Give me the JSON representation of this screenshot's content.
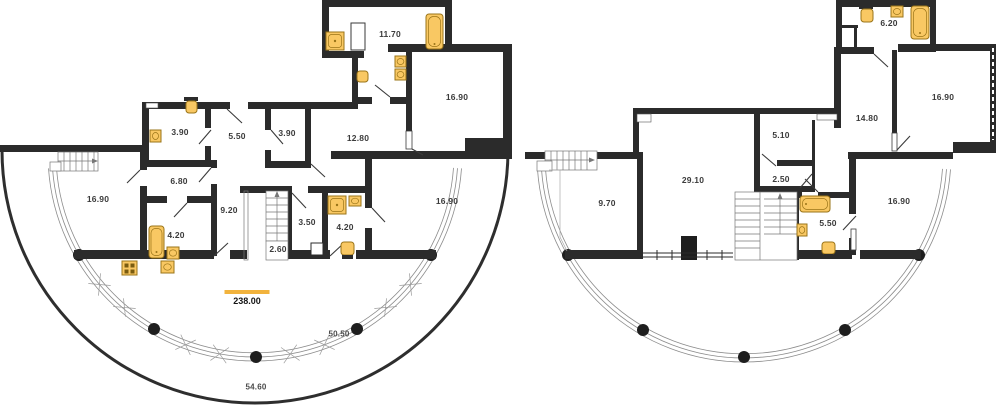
{
  "colors": {
    "wall": "#2B2B2B",
    "fixture_fill": "#F9C863",
    "fixture_stroke": "#9A7418",
    "accent": "#F2B33D",
    "arc_line": "#8C8C8C",
    "label_text": "#3B3B3B"
  },
  "plans": {
    "left": {
      "rooms": [
        {
          "area": "11.70"
        },
        {
          "area": "16.90"
        },
        {
          "area": "3.90"
        },
        {
          "area": "5.50"
        },
        {
          "area": "3.90"
        },
        {
          "area": "12.80"
        },
        {
          "area": "16.90"
        },
        {
          "area": "6.80"
        },
        {
          "area": "9.20"
        },
        {
          "area": "4.20"
        },
        {
          "area": "3.50"
        },
        {
          "area": "2.60"
        },
        {
          "area": "4.20"
        },
        {
          "area": "16.90"
        }
      ],
      "terrace": {
        "total_area": "238.00",
        "inner_arc": "50.50",
        "outer_arc": "54.60"
      }
    },
    "right": {
      "rooms": [
        {
          "area": "6.20"
        },
        {
          "area": "16.90"
        },
        {
          "area": "14.80"
        },
        {
          "area": "5.10"
        },
        {
          "area": "2.50"
        },
        {
          "area": "29.10"
        },
        {
          "area": "9.70"
        },
        {
          "area": "5.50"
        },
        {
          "area": "16.90"
        }
      ]
    }
  }
}
